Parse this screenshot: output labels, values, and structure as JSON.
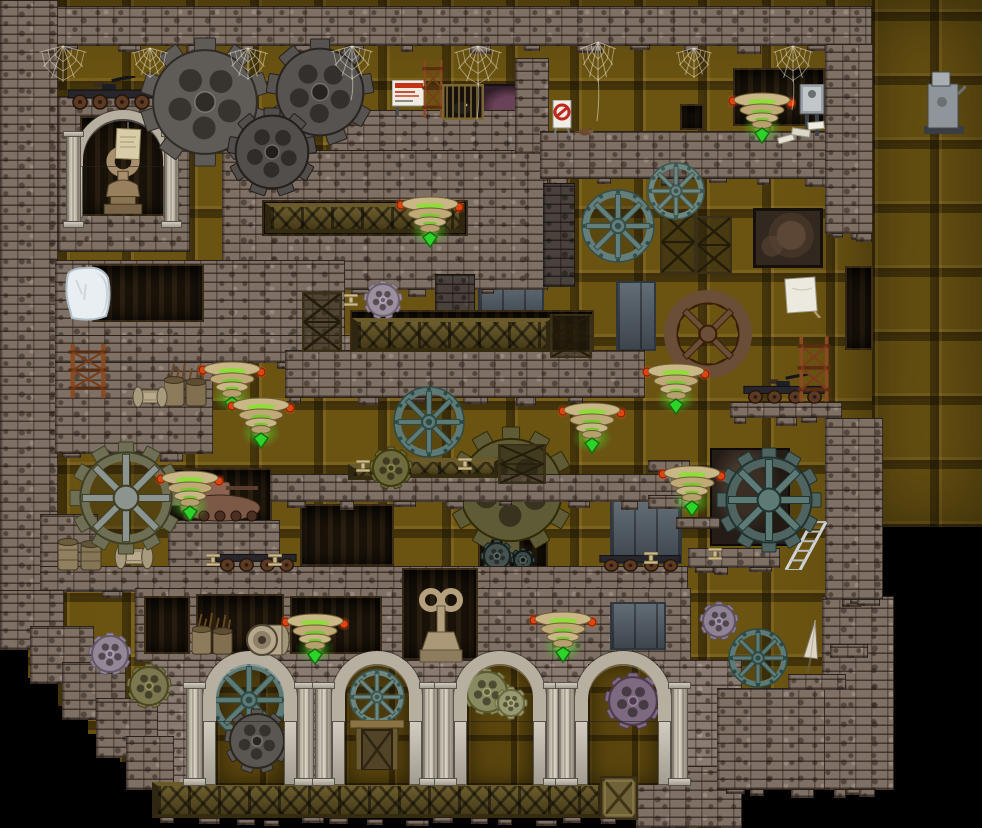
{
  "meta": {
    "domain": "game",
    "description": "2D steampunk platformer level: brick dungeon with metal panel walls, many gears, glowing collectible lamps, spider webs, mine carts, stone arches",
    "canvas": {
      "width": 982,
      "height": 828
    }
  },
  "palette": {
    "background": "#000000",
    "panel": "#6b5412",
    "brick": "#7e7065",
    "brick_dark": "#4a3f36",
    "stone": "#c9c3b8",
    "wood_truss": "#5d5026",
    "gear_gray": "#5f5b57",
    "gear_teal": "#5d7a76",
    "gear_olive": "#6e6b3e",
    "gear_lavender": "#948798",
    "gear_brown": "#6a4e38",
    "collectible_disc": "#c9b787",
    "collectible_glow": "#2ed32a",
    "orb_red": "#e2440f",
    "web": "#ece6d0",
    "slate": "#55606a",
    "ice": "#e9eef2",
    "rust": "#8a4a22"
  },
  "scene_data": {
    "panels": [
      [
        0,
        0,
        880,
        788
      ],
      [
        872,
        0,
        110,
        527
      ]
    ],
    "black_steps": [
      [
        0,
        648,
        28,
        140
      ],
      [
        24,
        678,
        34,
        110
      ],
      [
        54,
        706,
        34,
        84
      ],
      [
        84,
        734,
        36,
        56
      ],
      [
        118,
        762,
        40,
        28
      ]
    ],
    "backdrops": [
      [
        "cave",
        476,
        84,
        56,
        48
      ],
      [
        "dark",
        733,
        68,
        92,
        58
      ],
      [
        "dark",
        680,
        104,
        24,
        26
      ],
      [
        "mural",
        753,
        208,
        70,
        60
      ],
      [
        "dark",
        845,
        266,
        28,
        84
      ],
      [
        "slate",
        478,
        281,
        66,
        40
      ],
      [
        "slate",
        616,
        281,
        40,
        70
      ],
      [
        "dark",
        168,
        468,
        104,
        58
      ],
      [
        "mural2",
        710,
        448,
        80,
        98
      ],
      [
        "dark",
        300,
        504,
        94,
        62
      ],
      [
        "dark",
        478,
        538,
        70,
        32
      ],
      [
        "slate",
        610,
        500,
        72,
        64
      ]
    ],
    "gears_back": [
      [
        "gear-large-olive-cog",
        511,
        490,
        63,
        "cog",
        "#5e5b36",
        12,
        null
      ],
      [
        "gear-small-dark-cog",
        497,
        556,
        16,
        "cog",
        "#46524f",
        8,
        null
      ],
      [
        "gear-small-dark-cog",
        523,
        560,
        12,
        "cog",
        "#3e4a48",
        8,
        null
      ]
    ],
    "bricks": [
      [
        0,
        6,
        872,
        40,
        "n",
        1
      ],
      [
        0,
        0,
        58,
        612,
        "n",
        0
      ],
      [
        58,
        96,
        132,
        156,
        "n",
        0
      ],
      [
        330,
        110,
        218,
        44,
        "n",
        0
      ],
      [
        222,
        150,
        326,
        140,
        "n",
        1
      ],
      [
        515,
        58,
        34,
        96,
        "n",
        0
      ],
      [
        540,
        131,
        332,
        48,
        "n",
        1
      ],
      [
        825,
        44,
        48,
        190,
        "n",
        1
      ],
      [
        543,
        183,
        32,
        104,
        "d",
        0
      ],
      [
        435,
        274,
        40,
        48,
        "d",
        0
      ],
      [
        55,
        260,
        290,
        78,
        "n",
        0
      ],
      [
        55,
        335,
        338,
        28,
        "n",
        1
      ],
      [
        55,
        362,
        158,
        92,
        "n",
        1
      ],
      [
        285,
        350,
        360,
        48,
        "n",
        1
      ],
      [
        270,
        474,
        418,
        28,
        "n",
        1
      ],
      [
        40,
        514,
        58,
        58,
        "n",
        0
      ],
      [
        168,
        520,
        112,
        50,
        "n",
        0
      ],
      [
        40,
        566,
        648,
        26,
        "n",
        1
      ],
      [
        135,
        588,
        556,
        74,
        "n",
        0
      ],
      [
        150,
        660,
        592,
        126,
        "l",
        0
      ],
      [
        636,
        766,
        106,
        62,
        "n",
        1
      ],
      [
        822,
        596,
        72,
        194,
        "n",
        1
      ],
      [
        717,
        688,
        108,
        102,
        "n",
        1
      ],
      [
        788,
        674,
        58,
        16,
        "n",
        0
      ],
      [
        830,
        644,
        38,
        14,
        "n",
        0
      ],
      [
        648,
        460,
        42,
        12,
        "n",
        0
      ],
      [
        648,
        495,
        48,
        14,
        "n",
        0
      ],
      [
        676,
        517,
        44,
        12,
        "n",
        0
      ],
      [
        688,
        548,
        92,
        20,
        "n",
        1
      ],
      [
        730,
        402,
        112,
        16,
        "n",
        1
      ],
      [
        825,
        418,
        58,
        182,
        "n",
        1
      ],
      [
        0,
        590,
        64,
        60,
        "n",
        0
      ],
      [
        30,
        626,
        64,
        58,
        "n",
        0
      ],
      [
        62,
        662,
        64,
        58,
        "n",
        0
      ],
      [
        96,
        698,
        62,
        60,
        "n",
        0
      ],
      [
        126,
        736,
        48,
        54,
        "n",
        0
      ]
    ],
    "cutouts": [
      [
        "dark",
        92,
        264,
        112,
        58
      ],
      [
        "dark",
        262,
        200,
        206,
        36
      ],
      [
        "dark",
        350,
        310,
        244,
        42
      ],
      [
        "dark",
        144,
        596,
        46,
        58
      ],
      [
        "dark",
        196,
        594,
        88,
        60
      ],
      [
        "dark",
        290,
        596,
        92,
        58
      ],
      [
        "dark",
        402,
        568,
        76,
        92
      ],
      [
        "slate",
        610,
        602,
        56,
        48
      ]
    ],
    "trusses": [
      [
        265,
        203,
        200,
        30
      ],
      [
        352,
        318,
        200,
        34
      ],
      [
        402,
        458,
        98,
        20
      ],
      [
        348,
        464,
        56,
        16
      ],
      [
        152,
        782,
        452,
        36
      ]
    ],
    "alcove": {
      "x": 70,
      "y": 110,
      "interior": [
        80,
        116,
        86,
        100
      ],
      "ring": [
        74,
        110,
        98,
        56
      ],
      "jambs": [
        [
          74,
          166,
          9,
          52
        ],
        [
          163,
          166,
          9,
          52
        ]
      ],
      "columns": [
        [
          66,
          136,
          15,
          86
        ],
        [
          164,
          136,
          15,
          86
        ]
      ],
      "statue_rel": [
        14,
        28,
        54,
        70
      ],
      "parchment_rel": [
        30,
        4,
        32,
        42
      ]
    },
    "arches": {
      "top": 664,
      "open_h": 121,
      "ring": 13,
      "list": [
        {
          "cx": 250,
          "ow": 68
        },
        {
          "cx": 377,
          "ow": 64
        },
        {
          "cx": 500,
          "ow": 66
        },
        {
          "cx": 623,
          "ow": 70
        }
      ],
      "gears": [
        [
          0,
          249,
          700,
          38,
          "wheel",
          "#5d7a76",
          null
        ],
        [
          0,
          257,
          741,
          32,
          "cog",
          "#5a5652",
          9
        ],
        [
          1,
          377,
          697,
          27,
          "wheel",
          "#6d8883",
          null
        ],
        [
          2,
          487,
          692,
          23,
          "cog",
          "#8a8a60",
          9
        ],
        [
          2,
          511,
          703,
          16,
          "cog",
          "#9a9a70",
          8
        ],
        [
          3,
          633,
          701,
          28,
          "cog",
          "#7d6a80",
          9
        ]
      ]
    },
    "gears_front": [
      [
        "gear-large-gray-cog",
        205,
        102,
        64,
        "cog",
        "#5f5b57",
        10,
        null
      ],
      [
        "gear-large-gray-cog",
        320,
        92,
        53,
        "cog",
        "#565350",
        9,
        null
      ],
      [
        "gear-gray-cog",
        272,
        152,
        44,
        "cog",
        "#514e4b",
        9,
        null
      ],
      [
        "gear-teal-wheel",
        618,
        226,
        36,
        "wheel",
        "#647f7b",
        null,
        null
      ],
      [
        "gear-teal-wheel",
        676,
        191,
        28,
        "wheel",
        "#6d8883",
        null,
        null
      ],
      [
        "gear-brown-ring-cog",
        708,
        334,
        42,
        "cogring",
        "#6a4e38",
        14,
        null
      ],
      [
        "gear-pink-cog",
        383,
        300,
        19,
        "cog",
        "#9c8f9e",
        9,
        null
      ],
      [
        "gear-teal-wheel",
        429,
        422,
        35,
        "wheel",
        "#5d7a76",
        null,
        null
      ],
      [
        "gear-olive-cog",
        391,
        468,
        21,
        "cog",
        "#6e6b3e",
        9,
        null
      ],
      [
        "gear-composite-cogwheel",
        126,
        498,
        56,
        "cogwheel",
        "#6f6f55",
        12,
        "#8b948f"
      ],
      [
        "gear-large-teal-cogwheel",
        769,
        500,
        52,
        "cogwheel",
        "#4f6360",
        12,
        "#5d7a76"
      ],
      [
        "gear-lavender-cog",
        110,
        654,
        21,
        "cog",
        "#948798",
        9,
        null
      ],
      [
        "gear-olive-cog",
        149,
        686,
        22,
        "cog",
        "#7b7850",
        9,
        null
      ],
      [
        "gear-lavender-cog",
        719,
        621,
        19,
        "cog",
        "#8f8294",
        9,
        null
      ],
      [
        "gear-teal-wheel",
        758,
        658,
        29,
        "wheel",
        "#5d7a76",
        null,
        null
      ]
    ],
    "collectibles": [
      [
        762,
        108
      ],
      [
        430,
        212
      ],
      [
        232,
        377
      ],
      [
        261,
        413
      ],
      [
        676,
        379
      ],
      [
        592,
        418
      ],
      [
        190,
        486
      ],
      [
        692,
        481
      ],
      [
        315,
        629
      ],
      [
        563,
        627
      ]
    ],
    "webs": [
      [
        63,
        44,
        52,
        40,
        0
      ],
      [
        150,
        46,
        40,
        34,
        0
      ],
      [
        248,
        46,
        44,
        36,
        0
      ],
      [
        352,
        44,
        46,
        38,
        26
      ],
      [
        478,
        44,
        52,
        44,
        40
      ],
      [
        598,
        40,
        40,
        44,
        46
      ],
      [
        694,
        46,
        40,
        34,
        0
      ],
      [
        793,
        44,
        44,
        40,
        34
      ]
    ],
    "props": [
      [
        "cart",
        66,
        76,
        88,
        34,
        1
      ],
      [
        "cart",
        214,
        542,
        84,
        30,
        0
      ],
      [
        "cart",
        598,
        544,
        84,
        28,
        0
      ],
      [
        "cart",
        742,
        374,
        84,
        30,
        1
      ],
      [
        "barrels",
        56,
        534,
        48,
        38,
        0
      ],
      [
        "plantbarrels",
        164,
        362,
        44,
        46,
        0
      ],
      [
        "plantbarrels",
        192,
        612,
        42,
        44,
        0
      ],
      [
        "spool",
        246,
        622,
        46,
        36,
        0
      ],
      [
        "spool-lying",
        132,
        386,
        36,
        22,
        0
      ],
      [
        "spool-lying",
        114,
        544,
        40,
        26,
        0
      ],
      [
        "ice",
        62,
        264,
        52,
        58,
        0
      ],
      [
        "sign-caution",
        392,
        80,
        34,
        36,
        0
      ],
      [
        "sign-noentry",
        551,
        100,
        22,
        36,
        0
      ],
      [
        "rat",
        574,
        126,
        20,
        10,
        0
      ],
      [
        "canvas",
        784,
        276,
        38,
        42,
        0
      ],
      [
        "junctionbox",
        798,
        84,
        28,
        52,
        0
      ],
      [
        "machine",
        922,
        70,
        44,
        66,
        0
      ],
      [
        "key-statue",
        414,
        588,
        54,
        76,
        0
      ],
      [
        "umbrella",
        799,
        618,
        26,
        58,
        0
      ],
      [
        "ladder",
        782,
        520,
        46,
        50,
        0
      ],
      [
        "trestle",
        64,
        342,
        48,
        58,
        0
      ],
      [
        "trestle",
        794,
        334,
        40,
        70,
        0
      ],
      [
        "trestle",
        420,
        58,
        26,
        62,
        0
      ],
      [
        "cage",
        442,
        84,
        42,
        36,
        0
      ],
      [
        "lattice",
        660,
        210,
        36,
        64,
        0
      ],
      [
        "lattice",
        696,
        216,
        36,
        58,
        0
      ],
      [
        "lattice",
        302,
        292,
        40,
        60,
        0
      ],
      [
        "lattice",
        498,
        444,
        48,
        40,
        0
      ],
      [
        "lattice",
        550,
        314,
        42,
        44,
        0
      ],
      [
        "door",
        350,
        720,
        54,
        50,
        0
      ],
      [
        "crate",
        600,
        776,
        38,
        44,
        0
      ],
      [
        "debris",
        776,
        116,
        54,
        32,
        0
      ],
      [
        "tank",
        172,
        474,
        96,
        50,
        0
      ],
      [
        "anchor",
        344,
        294,
        14,
        12,
        0
      ],
      [
        "anchor",
        356,
        460,
        14,
        12,
        0
      ],
      [
        "anchor",
        458,
        458,
        14,
        12,
        0
      ],
      [
        "anchor",
        206,
        554,
        14,
        12,
        0
      ],
      [
        "anchor",
        268,
        554,
        14,
        12,
        0
      ],
      [
        "anchor",
        644,
        552,
        14,
        12,
        0
      ],
      [
        "anchor",
        708,
        548,
        14,
        12,
        0
      ]
    ],
    "crumb_rows": [
      [
        160,
        817,
        470
      ]
    ]
  }
}
